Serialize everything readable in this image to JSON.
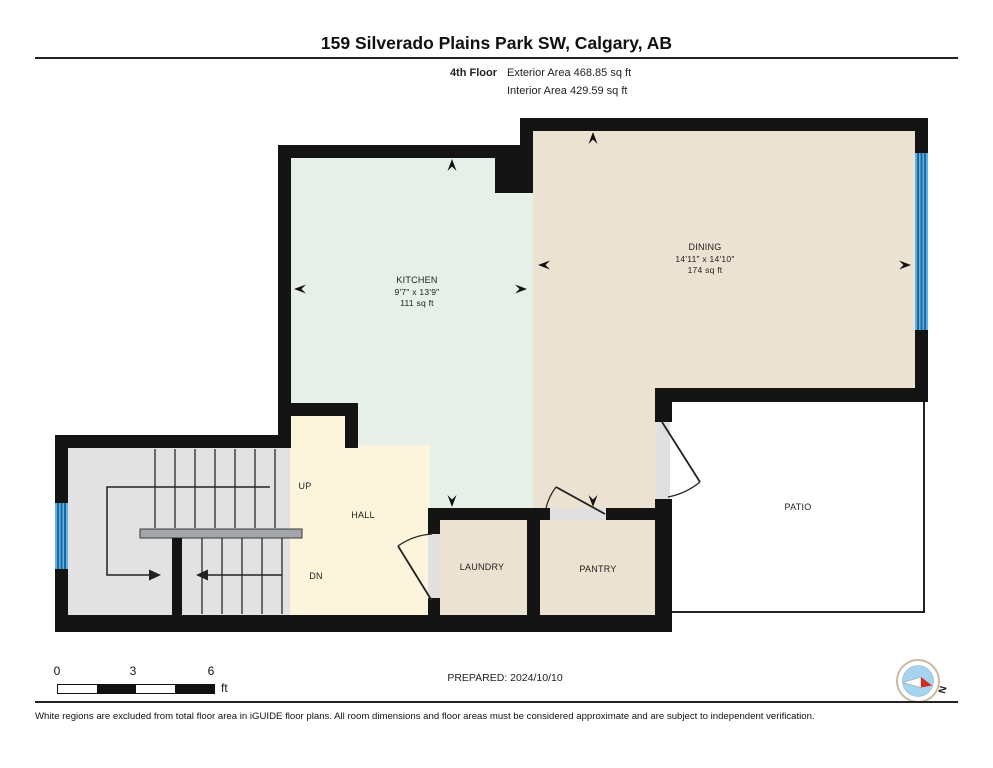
{
  "header": {
    "title": "159 Silverado Plains Park SW, Calgary, AB",
    "floor_label": "4th Floor",
    "exterior_area": "Exterior Area 468.85 sq ft",
    "interior_area": "Interior Area 429.59 sq ft"
  },
  "rooms": {
    "kitchen": {
      "name": "KITCHEN",
      "dimensions": "9'7\" x 13'9\"",
      "area": "111 sq ft"
    },
    "dining": {
      "name": "DINING",
      "dimensions": "14'11\" x 14'10\"",
      "area": "174 sq ft"
    },
    "hall": {
      "name": "HALL"
    },
    "laundry": {
      "name": "LAUNDRY"
    },
    "pantry": {
      "name": "PANTRY"
    },
    "patio": {
      "name": "PATIO"
    }
  },
  "stairs": {
    "up_label": "UP",
    "down_label": "DN"
  },
  "scale_bar": {
    "tick0": "0",
    "tick3": "3",
    "tick6": "6",
    "unit": "ft"
  },
  "footer": {
    "prepared": "PREPARED: 2024/10/10",
    "compass_north": "N",
    "disclaimer": "White regions are excluded from total floor area in iGUIDE floor plans. All room dimensions and floor areas must be considered approximate and are subject to independent verification."
  },
  "colors": {
    "wall": "#141414",
    "kitchen_floor": "#e7efe9",
    "dining_floor": "#ebe2d2",
    "hall_floor": "#fcf5dc",
    "stairs_floor": "#e2e2e2",
    "patio_floor": "#ffffff",
    "window_blue": "#57aede",
    "window_line": "#20689b",
    "compass_red": "#d42a20",
    "compass_blue": "#a6d3ee"
  }
}
